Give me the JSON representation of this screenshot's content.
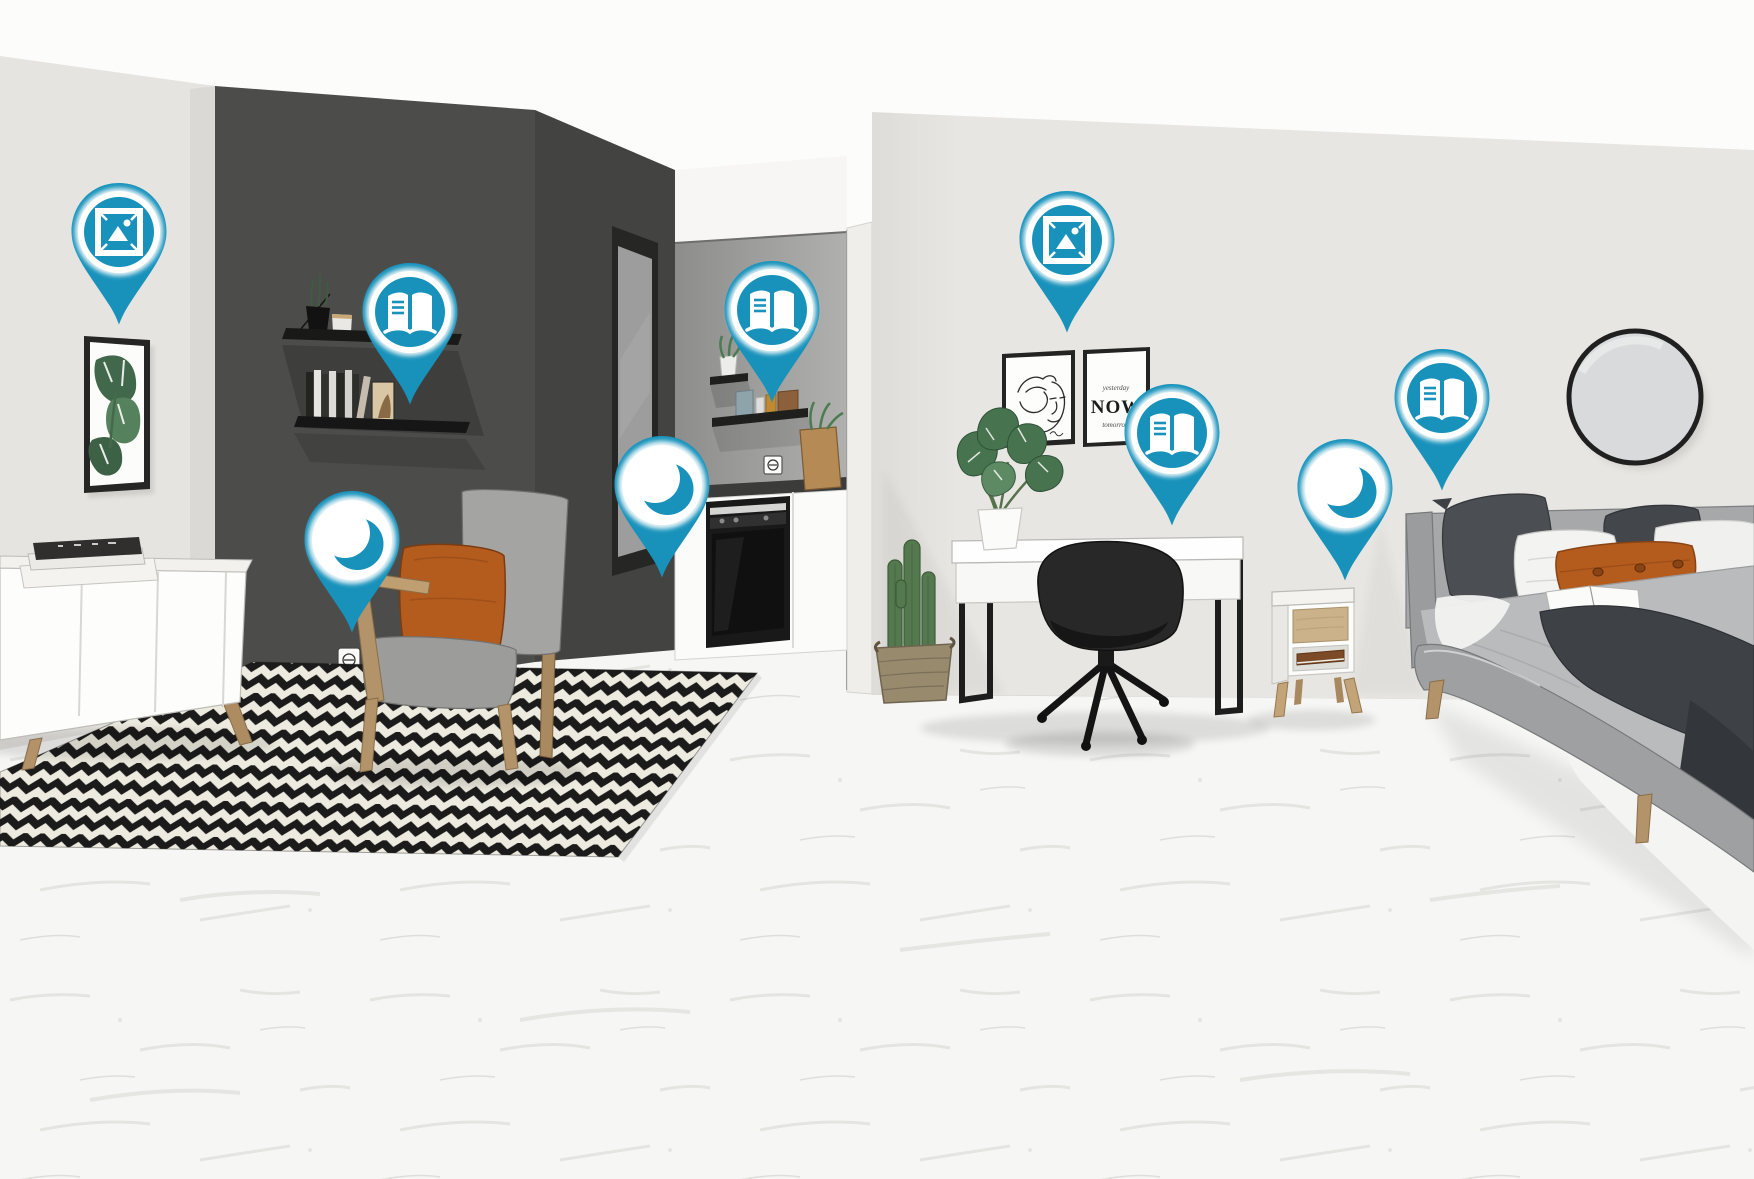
{
  "colors": {
    "pin": "#1892bb",
    "accent_orange": "#b45b1e",
    "dark_wall": "#4c4c4b",
    "left_wall": "#e6e4e0",
    "right_wall": "#e8e6e2",
    "kitchen_wall": "#b0b0af",
    "floor": "#f6f6f4",
    "rug_black": "#1b1b1b",
    "rug_white": "#edebdf"
  },
  "pins": [
    {
      "id": "pin-wall-art-left",
      "icon": "picture",
      "x": 119,
      "y": 232
    },
    {
      "id": "pin-bookshelf-dark-wall",
      "icon": "book",
      "x": 410,
      "y": 312
    },
    {
      "id": "pin-armchair-corner",
      "icon": "moon",
      "x": 352,
      "y": 540
    },
    {
      "id": "pin-kitchen",
      "icon": "moon",
      "x": 662,
      "y": 485
    },
    {
      "id": "pin-kitchen-shelf",
      "icon": "book",
      "x": 772,
      "y": 310
    },
    {
      "id": "pin-wall-art-right",
      "icon": "picture",
      "x": 1067,
      "y": 240
    },
    {
      "id": "pin-desk",
      "icon": "book",
      "x": 1172,
      "y": 433
    },
    {
      "id": "pin-nightstand",
      "icon": "moon",
      "x": 1345,
      "y": 488
    },
    {
      "id": "pin-bed",
      "icon": "book",
      "x": 1442,
      "y": 398
    }
  ],
  "posters": {
    "now": {
      "line1": "yesterday",
      "line2": "NOW",
      "line3": "tomorrow"
    }
  }
}
